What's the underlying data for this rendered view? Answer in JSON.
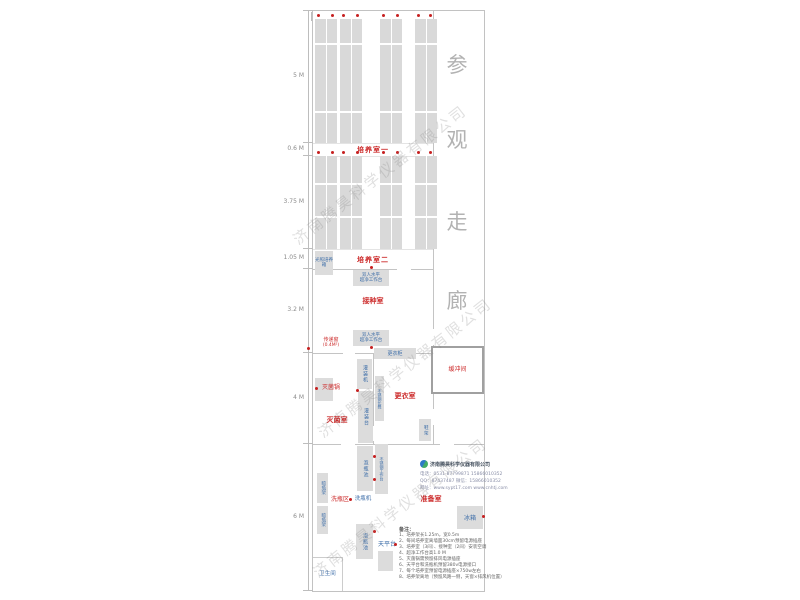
{
  "watermark": {
    "text": "济南腾昊科学仪器有限公司"
  },
  "dims": {
    "top_48": "4.8 M",
    "top_21": "2.1 M",
    "left": [
      "5 M",
      "0.6 M",
      "3.75 M",
      "1.05 M",
      "3.2 M",
      "4 M",
      "6 M"
    ]
  },
  "corridor": {
    "text": "参观走廊"
  },
  "rooms": {
    "culture1": "培养室一",
    "culture2": "培养室二",
    "inoculation": "接种室",
    "sterilization": "灭菌室",
    "changing": "更衣室",
    "buffer": "缓冲间",
    "prep": "准备室",
    "wash_area": "洗瓶区",
    "toilet": "卫生间",
    "pass_window": "传递窗",
    "pass_window_size": "(0.4M²)"
  },
  "equipment": {
    "light_incubator": "光照培养箱",
    "clean_bench_l1": "双人水平",
    "clean_bench_l2": "超净工作台",
    "locker": "更衣柜",
    "autoclave": "灭菌锅",
    "filling_machine": "灌装机",
    "filling_table": "灌装台",
    "ss_bench": "不锈钢长凳",
    "shoe_rack": "鞋架",
    "soak_pool": "泡瓶池",
    "ss_worktable": "不锈钢工作台",
    "bottle_washer": "洗瓶机",
    "drying_rack": "晾瓶架",
    "balance_table": "天平台",
    "fridge": "冰箱"
  },
  "company": {
    "name": "济南腾昊科学仪器有限公司",
    "line1": "电话：0531-87799871  15866010352",
    "line2": "QQ：87437487  微信：15866010352",
    "line3": "网址：www.sypt17.com  www.cnhtj.com"
  },
  "notes": {
    "title": "备注：",
    "items": [
      "1、培养架长1.25m，宽0.5m",
      "2、每间培养室离墙面30cm预留电源插座",
      "3、培养室（3间）、接种室（2间）安装空调",
      "4、超净工作台高1.0 M",
      "5、灭菌锅需预留排风电源插座",
      "6、天平台和洗瓶机预留380v电源接口",
      "7、每个培养室预留电源插座×750w左右",
      "8、培养架离地（预留风路一侧，天窗×排风机位置）"
    ]
  },
  "colors": {
    "room_label": "#cc2a2a",
    "equipment_label": "#3c6da8",
    "shelf_fill": "#d9d9d9",
    "wall": "#c4c4c4",
    "outlet_dot": "#c62020"
  }
}
